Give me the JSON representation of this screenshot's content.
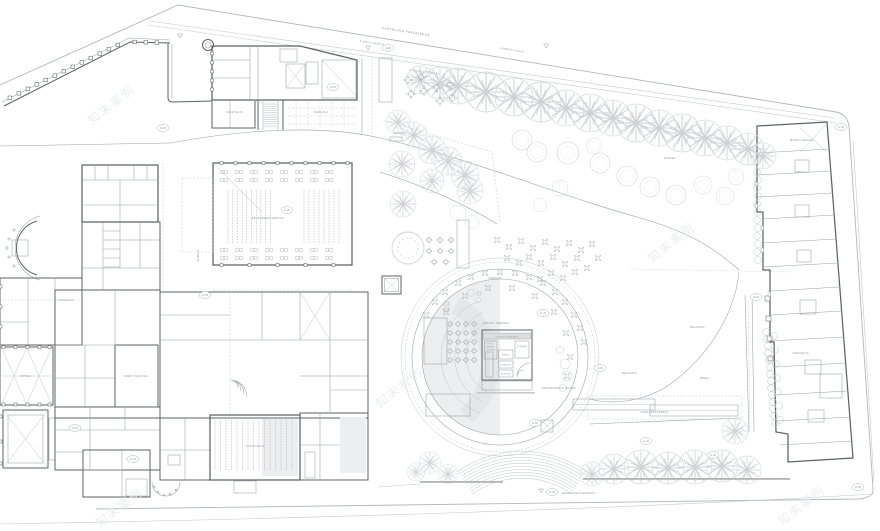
{
  "colors": {
    "paper": "#ffffff",
    "wall_line": "#5d6266",
    "thin_line": "#9aa0a4",
    "boundary_line": "#b3b7ba",
    "tree_line": "#cfd2d4",
    "shading": "#eceeef",
    "label_text": "#8f9497"
  },
  "watermark": {
    "text": "知末案例"
  },
  "labels": {
    "street_1": "GAZTELUKO PASEALEKUA",
    "street_2": "ESPALOI BERRIA",
    "street_3": "SARRERA KALEA",
    "terrace_top": "KANPOKO TERRAZA",
    "cafe": "KAFETEGIA",
    "pergola": "PERGOLA",
    "exhibition_hall": "ERAKUSKETA ARETOA",
    "stage": "ESZENA",
    "workrooms": "LANGELAK",
    "main_hall": "ARETO NAGUSIA",
    "courtyard": "PATIOA",
    "auditorium": "AUDITORIOA",
    "terrace_circle": "TERRAZA",
    "kiosk_area": "KIOSKO TERRAZA",
    "program_area": "PROGRAMAZIO GUNEA",
    "park": "PARKEA",
    "lawn": "BELARDIA",
    "lawn2": "BELARDIA",
    "parterre": "LORE PARTERREAK",
    "museum_wing": "MUSEO HEGALA",
    "garden_east": "LORATEGIA",
    "bottom_note": "ERAKUSKETA EREMUA",
    "bench": "BANKUA",
    "path": "BIDEA"
  },
  "kiosk": {
    "title": "KIOSKOA · OINPLANOA",
    "legend_1": "KUTXA",
    "legend_2": "EDARIAK",
    "legend_3": "IZOZKIAK",
    "room_1": "BARRA",
    "room_2": "SUKALDEA",
    "room_3": "BILTEGIA",
    "room_4": "KOMUNAK"
  },
  "badges": [
    "11.05",
    "11.20",
    "10.95",
    "11.35",
    "11.05",
    "11.10",
    "11.40",
    "11.05",
    "11.25",
    "11.05",
    "11.15",
    "11.30",
    "11.05",
    "11.20",
    "11.10",
    "11.05"
  ]
}
